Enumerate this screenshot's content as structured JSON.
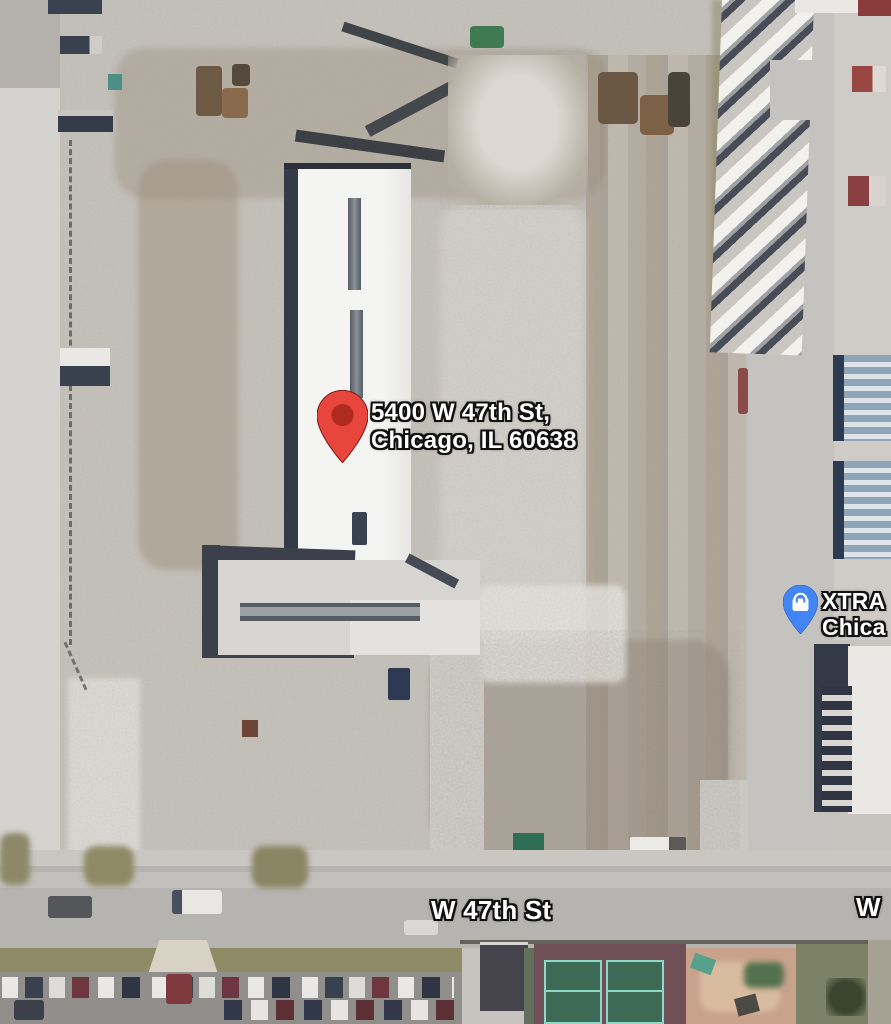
{
  "map": {
    "view_type": "satellite",
    "destination_marker": {
      "address_line1": "5400 W 47th St,",
      "address_line2": "Chicago, IL 60638",
      "pin_color": "#E8453C",
      "pin_dot_color": "#AF2A20"
    },
    "business_marker": {
      "name_line1": "XTRA",
      "name_line2": "Chica",
      "pin_color": "#4285F4",
      "icon": "shopping-bag-icon",
      "icon_color": "#FFFFFF"
    },
    "street_labels": {
      "main": "W 47th St",
      "right_edge": "W"
    }
  }
}
